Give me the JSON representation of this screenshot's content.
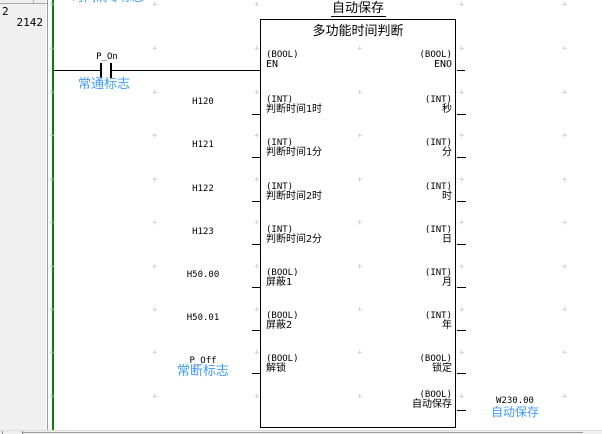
{
  "margin": {
    "rung_number": "2",
    "step_number": "2142"
  },
  "top_comment": "时间清零标志",
  "rung": {
    "contact": {
      "operand": "P_On",
      "comment": "常通标志"
    }
  },
  "function_block": {
    "instance_name": "自动保存",
    "fb_name": "多功能时间判断",
    "en": {
      "type": "(BOOL)",
      "label": "EN"
    },
    "eno": {
      "type": "(BOOL)",
      "label": "ENO"
    },
    "inputs": [
      {
        "operand": "H120",
        "type": "(INT)",
        "name": "判断时间1时"
      },
      {
        "operand": "H121",
        "type": "(INT)",
        "name": "判断时间1分"
      },
      {
        "operand": "H122",
        "type": "(INT)",
        "name": "判断时间2时"
      },
      {
        "operand": "H123",
        "type": "(INT)",
        "name": "判断时间2分"
      },
      {
        "operand": "H50.00",
        "type": "(BOOL)",
        "name": "屏蔽1"
      },
      {
        "operand": "H50.01",
        "type": "(BOOL)",
        "name": "屏蔽2"
      },
      {
        "operand": "P_Off",
        "operand_comment": "常断标志",
        "type": "(BOOL)",
        "name": "解锁"
      }
    ],
    "outputs": [
      {
        "type": "(INT)",
        "name": "秒"
      },
      {
        "type": "(INT)",
        "name": "分"
      },
      {
        "type": "(INT)",
        "name": "时"
      },
      {
        "type": "(INT)",
        "name": "日"
      },
      {
        "type": "(INT)",
        "name": "月"
      },
      {
        "type": "(INT)",
        "name": "年"
      },
      {
        "type": "(BOOL)",
        "name": "锁定"
      },
      {
        "type": "(BOOL)",
        "name": "自动保存",
        "operand": "W230.00",
        "operand_comment": "自动保存"
      }
    ]
  },
  "colors": {
    "comment_blue": "#3f9cf8",
    "rail_green": "#0e7c0e"
  }
}
